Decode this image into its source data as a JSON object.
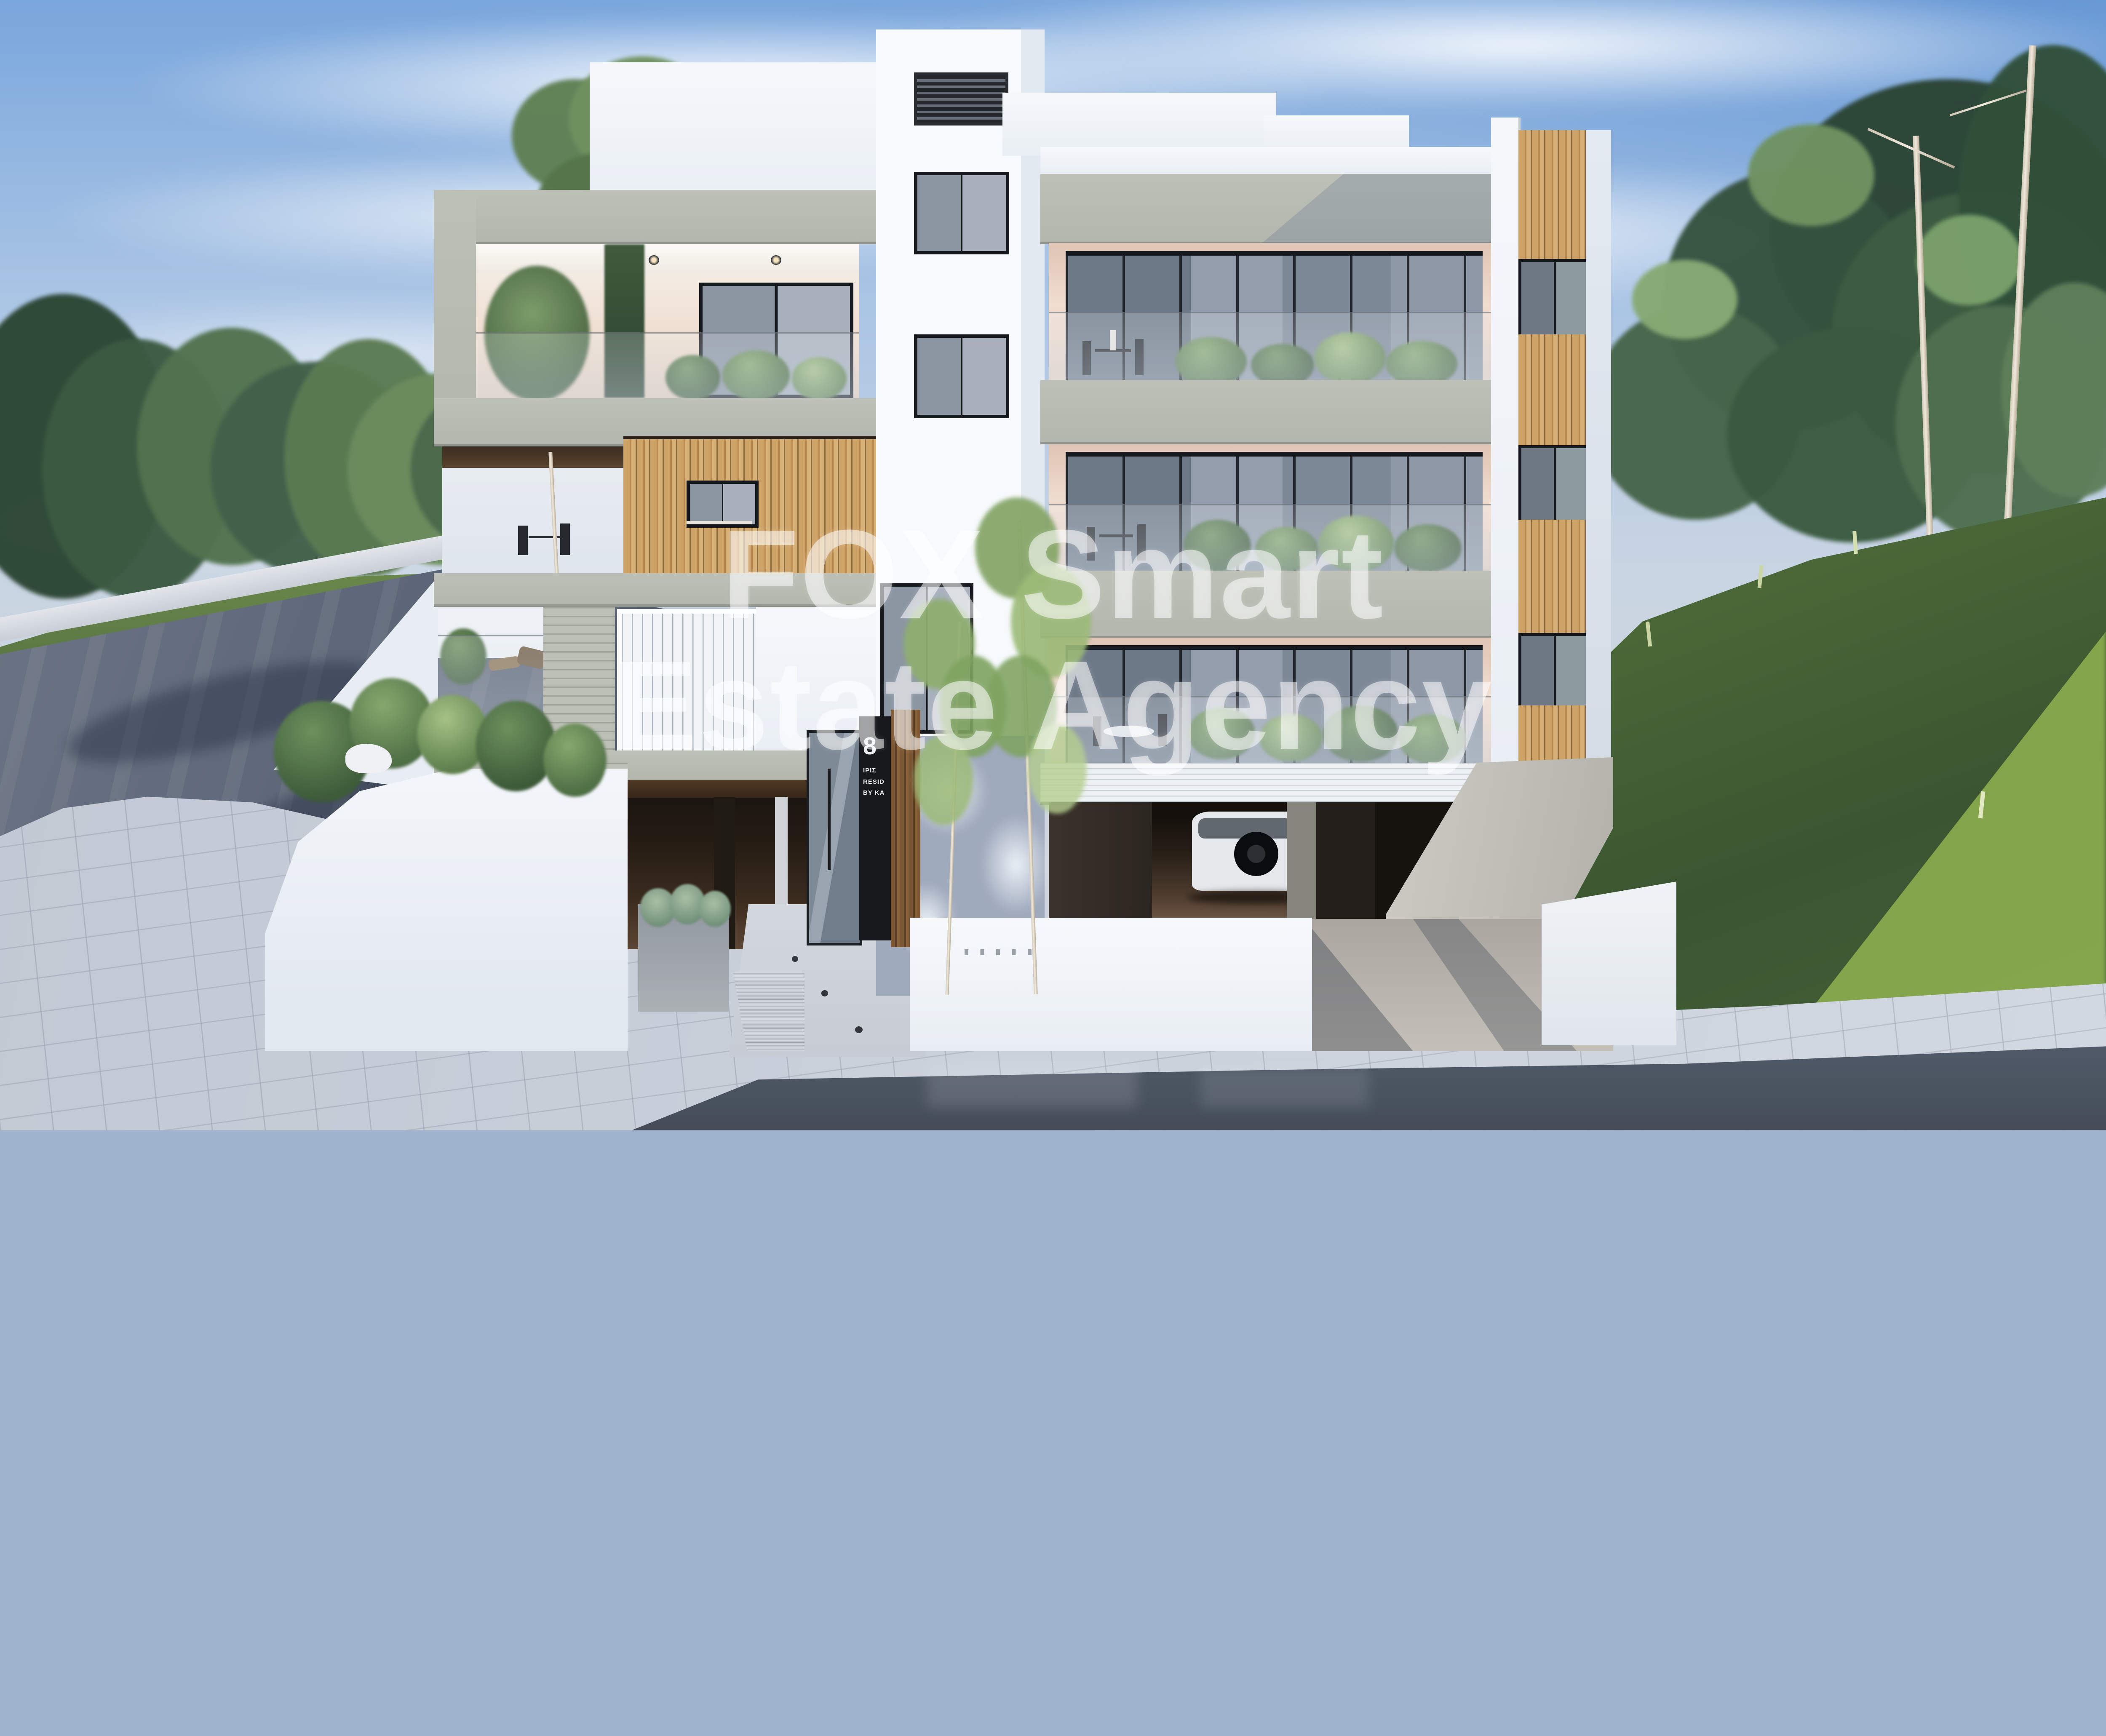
{
  "scene_type": "architectural-exterior-render",
  "watermark": {
    "line1": "FOX Smart",
    "line2": "Estate Agency"
  },
  "entrance_sign": {
    "number": "8",
    "lines": [
      "ΙΡΙΣ",
      "RESID",
      "BY KA"
    ]
  },
  "palette": {
    "skyTop": "#79a6dc",
    "skyMid": "#a9c4e4",
    "skyLow": "#c6d3e2",
    "concrete": "#bcc0b6",
    "woodLight": "#cda367",
    "woodDark": "#8f6a3e",
    "peach": "#f0ddd0",
    "whiteWall": "#f5f8fb",
    "shadowWall": "#9fa9bc",
    "frame": "#15181c",
    "roadWet": "#596273",
    "paving": "#c9cfd8",
    "grassHill": "#54743c",
    "grassBright": "#8fb050",
    "treeDark": "#2c4634",
    "treeLight": "#7d9c6a",
    "trunkPale": "#d5cbbb",
    "garageFloor": "#6b5443",
    "carBody": "#e4e8eb",
    "signPanel": "#17181b",
    "signText": "#eceff2",
    "watermarkColor": "rgba(255,255,255,0.52)"
  }
}
